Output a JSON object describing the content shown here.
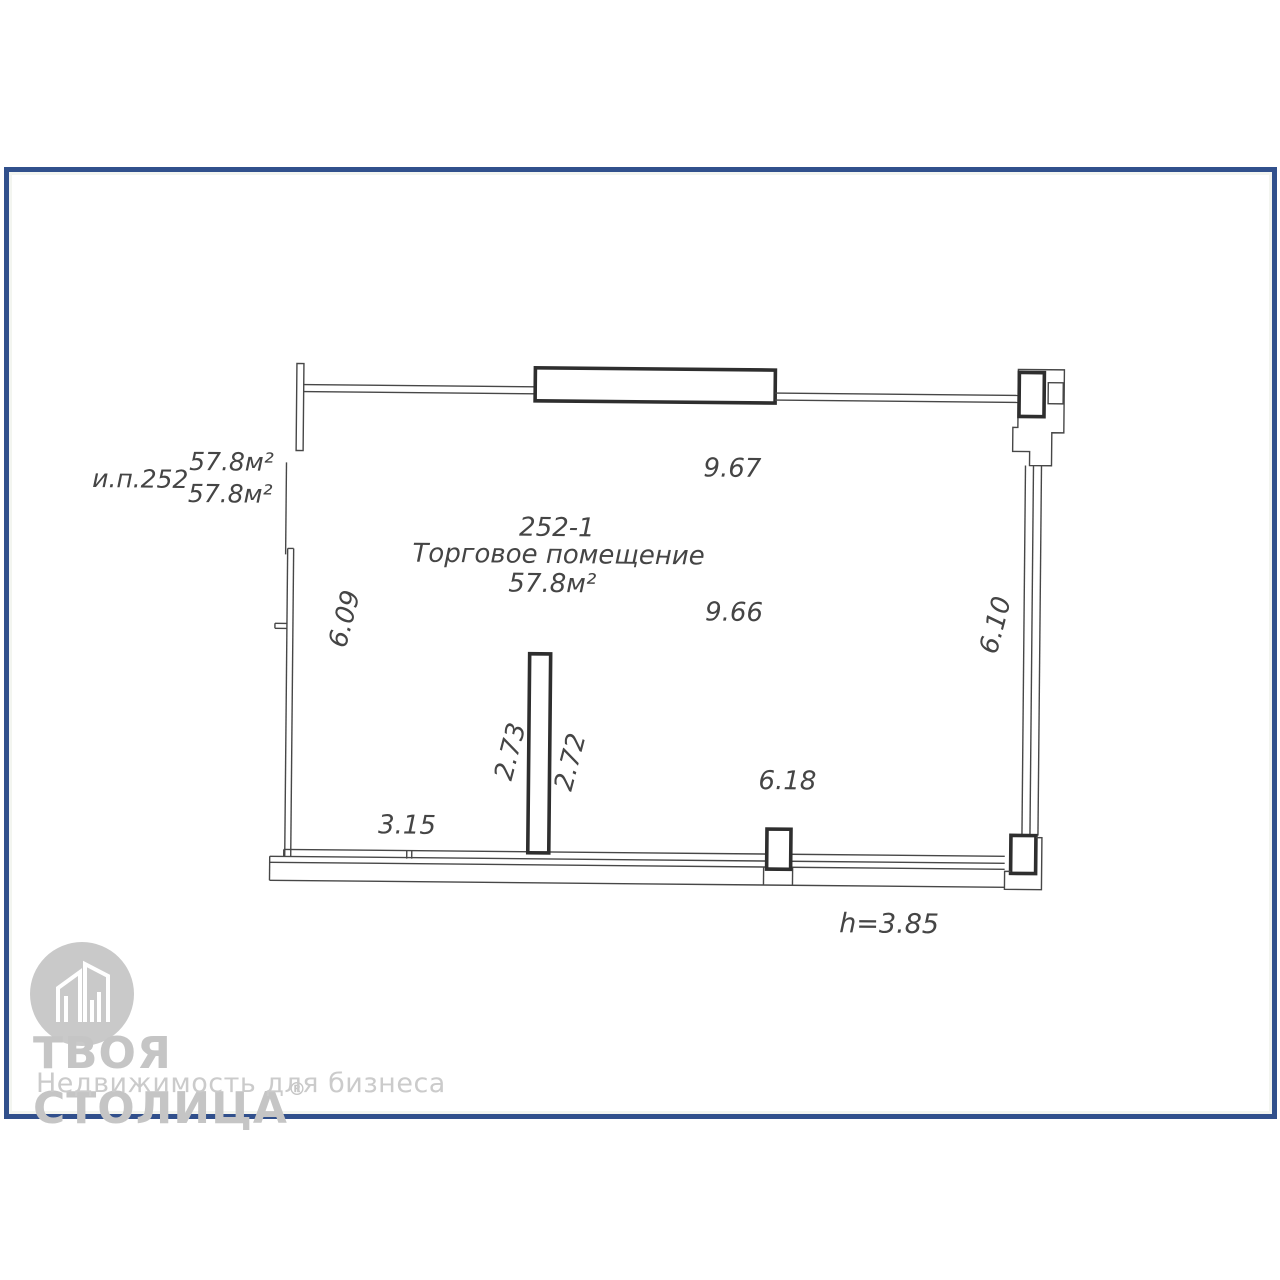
{
  "plan": {
    "unit_label": "и.п.252",
    "areas": {
      "upper": "57.8м²",
      "lower": "57.8м²"
    },
    "room": {
      "number": "252-1",
      "name": "Торговое помещение",
      "area": "57.8м²"
    },
    "dims": {
      "top": "9.67",
      "mid": "9.66",
      "left": "6.09",
      "right": "6.10",
      "partition_left": "2.73",
      "partition_right": "2.72",
      "bottom_left": "3.15",
      "bottom_right": "6.18",
      "ceiling_height": "h=3.85"
    }
  },
  "logo": {
    "title": "ТВОЯ СТОЛИЦА",
    "reg": "®",
    "subtitle": "Недвижимость для бизнеса"
  },
  "colors": {
    "frame": "#31508c",
    "line": "#474747",
    "logo": "#c5c5c5"
  }
}
